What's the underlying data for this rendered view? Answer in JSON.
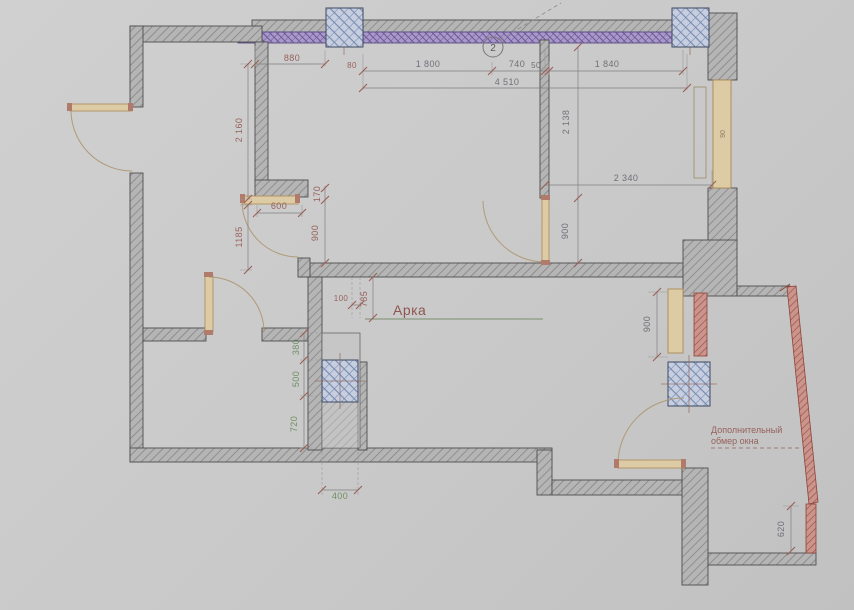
{
  "drawing": {
    "arch_label": "Арка",
    "callout": "2",
    "note": {
      "line1": "Дополнительный",
      "line2": "обмер окна"
    },
    "window_size_label": "90",
    "dims": {
      "top_880": "880",
      "top_80": "80",
      "top_1800": "1 800",
      "top_740": "740",
      "top_50": "50",
      "top_1840": "1 840",
      "top_total": "4 510",
      "left_2160": "2 160",
      "left_1185": "1185",
      "left_600": "600",
      "left_170": "170",
      "left_900": "900",
      "arch_100": "100",
      "arch_785": "785",
      "mid_2138": "2 138",
      "mid_900": "900",
      "mid_2340": "2 340",
      "win_900": "900",
      "right_620": "620",
      "shaft_380": "380",
      "shaft_500": "500",
      "shaft_720": "720",
      "shaft_400": "400"
    },
    "colors": {
      "wall_fill": "#b5b5b5",
      "wall_hatch": "#828282",
      "column_fill": "#c6cedf",
      "column_hatch": "#7589ae",
      "glazing_fill": "#a899c8",
      "glazing_hatch": "#6b5699",
      "window_fill": "#ddcba6",
      "red_accent": "#9e4e42",
      "dim_red": "#96625c",
      "dim_gray": "#6f7077",
      "dim_green": "#6f8f63",
      "outline": "#4e4e4e"
    }
  }
}
